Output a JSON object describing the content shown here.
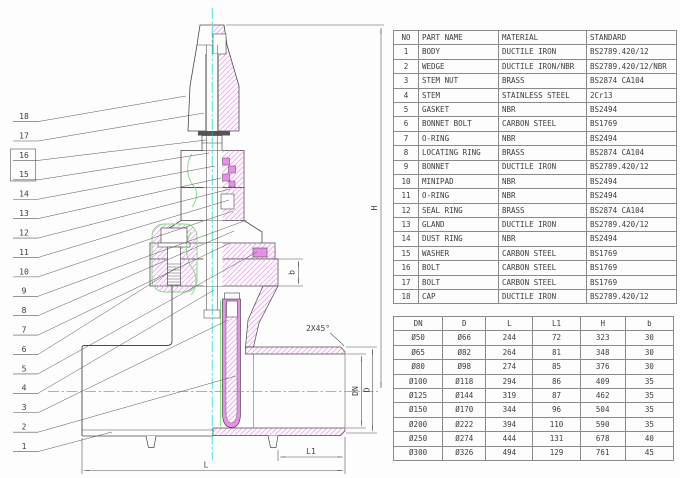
{
  "drawing": {
    "title_semantic": "gate-valve-cross-section",
    "callouts": [
      "18",
      "17",
      "16",
      "15",
      "14",
      "13",
      "12",
      "11",
      "10",
      "9",
      "8",
      "7",
      "6",
      "5",
      "4",
      "3",
      "2",
      "1"
    ],
    "dim_labels": {
      "h": "H",
      "b": "b",
      "dn": "DN",
      "d": "D",
      "l1": "L1",
      "l": "L",
      "chamfer": "2X45°"
    },
    "colors": {
      "outline": "#4a4a4a",
      "section_hatch_magenta": "#f0a4f0",
      "rubber_magenta": "#e98fe9",
      "seal_green": "#7ddc7d",
      "centerline_cyan": "#00d8d8"
    }
  },
  "parts_table": {
    "headers": [
      "NO",
      "PART NAME",
      "MATERIAL",
      "STANDARD"
    ],
    "rows": [
      [
        "1",
        "BODY",
        "DUCTILE IRON",
        "BS2789.420/12"
      ],
      [
        "2",
        "WEDGE",
        "DUCTILE IRON/NBR",
        "BS2789.420/12/NBR"
      ],
      [
        "3",
        "STEM NUT",
        "BRASS",
        "BS2874 CA104"
      ],
      [
        "4",
        "STEM",
        "STAINLESS STEEL",
        "2Cr13"
      ],
      [
        "5",
        "GASKET",
        "NBR",
        "BS2494"
      ],
      [
        "6",
        "BONNET BOLT",
        "CARBON STEEL",
        "BS1769"
      ],
      [
        "7",
        "O-RING",
        "NBR",
        "BS2494"
      ],
      [
        "8",
        "LOCATING RING",
        "BRASS",
        "BS2874 CA104"
      ],
      [
        "9",
        "BONNET",
        "DUCTILE IRON",
        "BS2789.420/12"
      ],
      [
        "10",
        "MINIPAD",
        "NBR",
        "BS2494"
      ],
      [
        "11",
        "O-RING",
        "NBR",
        "BS2494"
      ],
      [
        "12",
        "SEAL RING",
        "BRASS",
        "BS2874 CA104"
      ],
      [
        "13",
        "GLAND",
        "DUCTILE IRON",
        "BS2789.420/12"
      ],
      [
        "14",
        "DUST RING",
        "NBR",
        "BS2494"
      ],
      [
        "15",
        "WASHER",
        "CARBON STEEL",
        "BS1769"
      ],
      [
        "16",
        "BOLT",
        "CARBON STEEL",
        "BS1769"
      ],
      [
        "17",
        "BOLT",
        "CARBON STEEL",
        "BS1769"
      ],
      [
        "18",
        "CAP",
        "DUCTILE IRON",
        "BS2789.420/12"
      ]
    ]
  },
  "dimensions_table": {
    "headers": [
      "DN",
      "D",
      "L",
      "L1",
      "H",
      "b"
    ],
    "rows": [
      [
        "Ø50",
        "Ø66",
        "244",
        "72",
        "323",
        "30"
      ],
      [
        "Ø65",
        "Ø82",
        "264",
        "81",
        "348",
        "30"
      ],
      [
        "Ø80",
        "Ø98",
        "274",
        "85",
        "376",
        "30"
      ],
      [
        "Ø100",
        "Ø118",
        "294",
        "86",
        "409",
        "35"
      ],
      [
        "Ø125",
        "Ø144",
        "319",
        "87",
        "462",
        "35"
      ],
      [
        "Ø150",
        "Ø170",
        "344",
        "96",
        "504",
        "35"
      ],
      [
        "Ø200",
        "Ø222",
        "394",
        "110",
        "590",
        "35"
      ],
      [
        "Ø250",
        "Ø274",
        "444",
        "131",
        "678",
        "40"
      ],
      [
        "Ø300",
        "Ø326",
        "494",
        "129",
        "761",
        "45"
      ]
    ]
  }
}
